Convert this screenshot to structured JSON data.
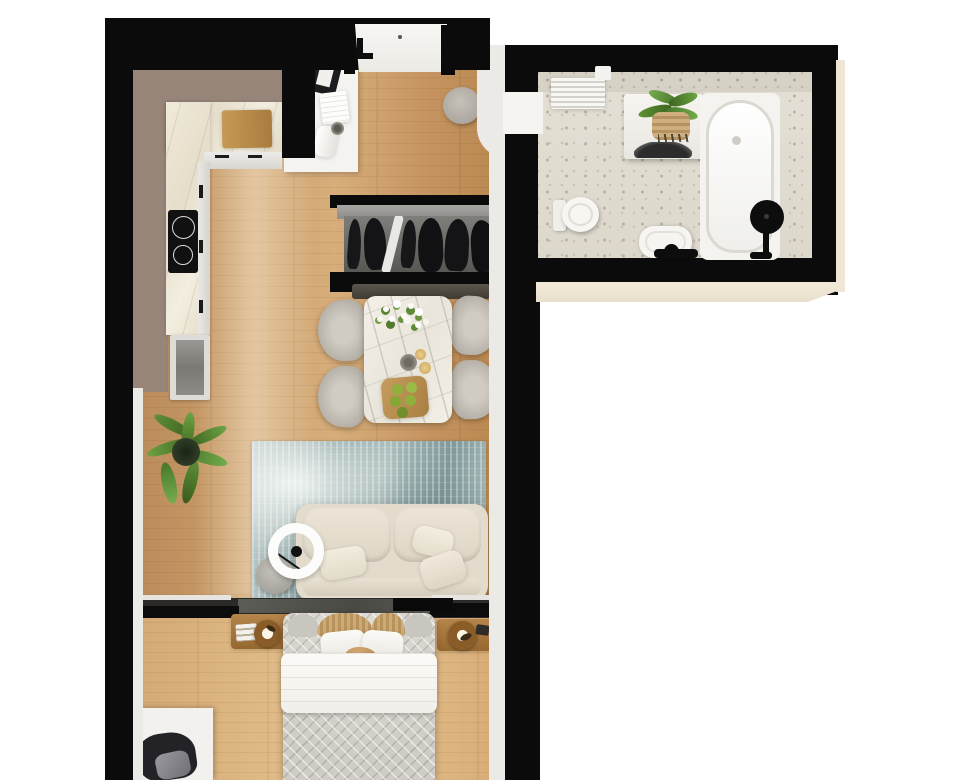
{
  "title": "apartment-3d-floor-plan-top-view",
  "palette": {
    "canvas": "#ffffff",
    "wall": "#0b0b0b",
    "white_wall": "#eceae6",
    "kitchen_wall": "#97857a",
    "quilt": "#cfccc5",
    "sofa": "#e3dccd",
    "wood_furniture": "#a87a43",
    "plant_green": "#5d8f3a",
    "glass": "#54544f",
    "beige_edge": "#efe6d6"
  },
  "rooms": {
    "kitchen": {
      "name": "kitchen",
      "items": [
        "l-shaped-marble-countertop",
        "induction-cooktop",
        "cutting-board",
        "cabinet-handles",
        "tall-cabinet"
      ]
    },
    "entry": {
      "name": "entry-hall",
      "items": [
        "entrance-door",
        "door-handle",
        "console-table",
        "laptop",
        "papers",
        "rolled-towel",
        "cup",
        "gray-pouf",
        "wardrobe-with-hanging-clothes",
        "bench"
      ]
    },
    "dining": {
      "name": "dining-area",
      "items": [
        "marble-dining-table",
        "upholstered-chair-x4",
        "flower-bouquet",
        "cups",
        "fruit-tray-with-apples"
      ]
    },
    "living": {
      "name": "living-area",
      "items": [
        "distressed-blue-rug",
        "cream-sofa",
        "throw-pillows",
        "arc-floor-lamp",
        "round-side-table",
        "potted-palm"
      ]
    },
    "bedroom": {
      "name": "bedroom",
      "items": [
        "glass-partition",
        "double-bed",
        "white-duvet",
        "pillows",
        "wicker-headboard-cushions",
        "nightstand-left",
        "nightstand-right",
        "round-table-lamps",
        "white-desk",
        "desk-chair"
      ]
    },
    "bathroom": {
      "name": "bathroom",
      "items": [
        "bathtub",
        "black-shower-head",
        "washing-machine",
        "plant-on-washer",
        "toilet",
        "sink-with-black-faucet",
        "towel-radiator",
        "terrazzo-floor"
      ]
    }
  }
}
